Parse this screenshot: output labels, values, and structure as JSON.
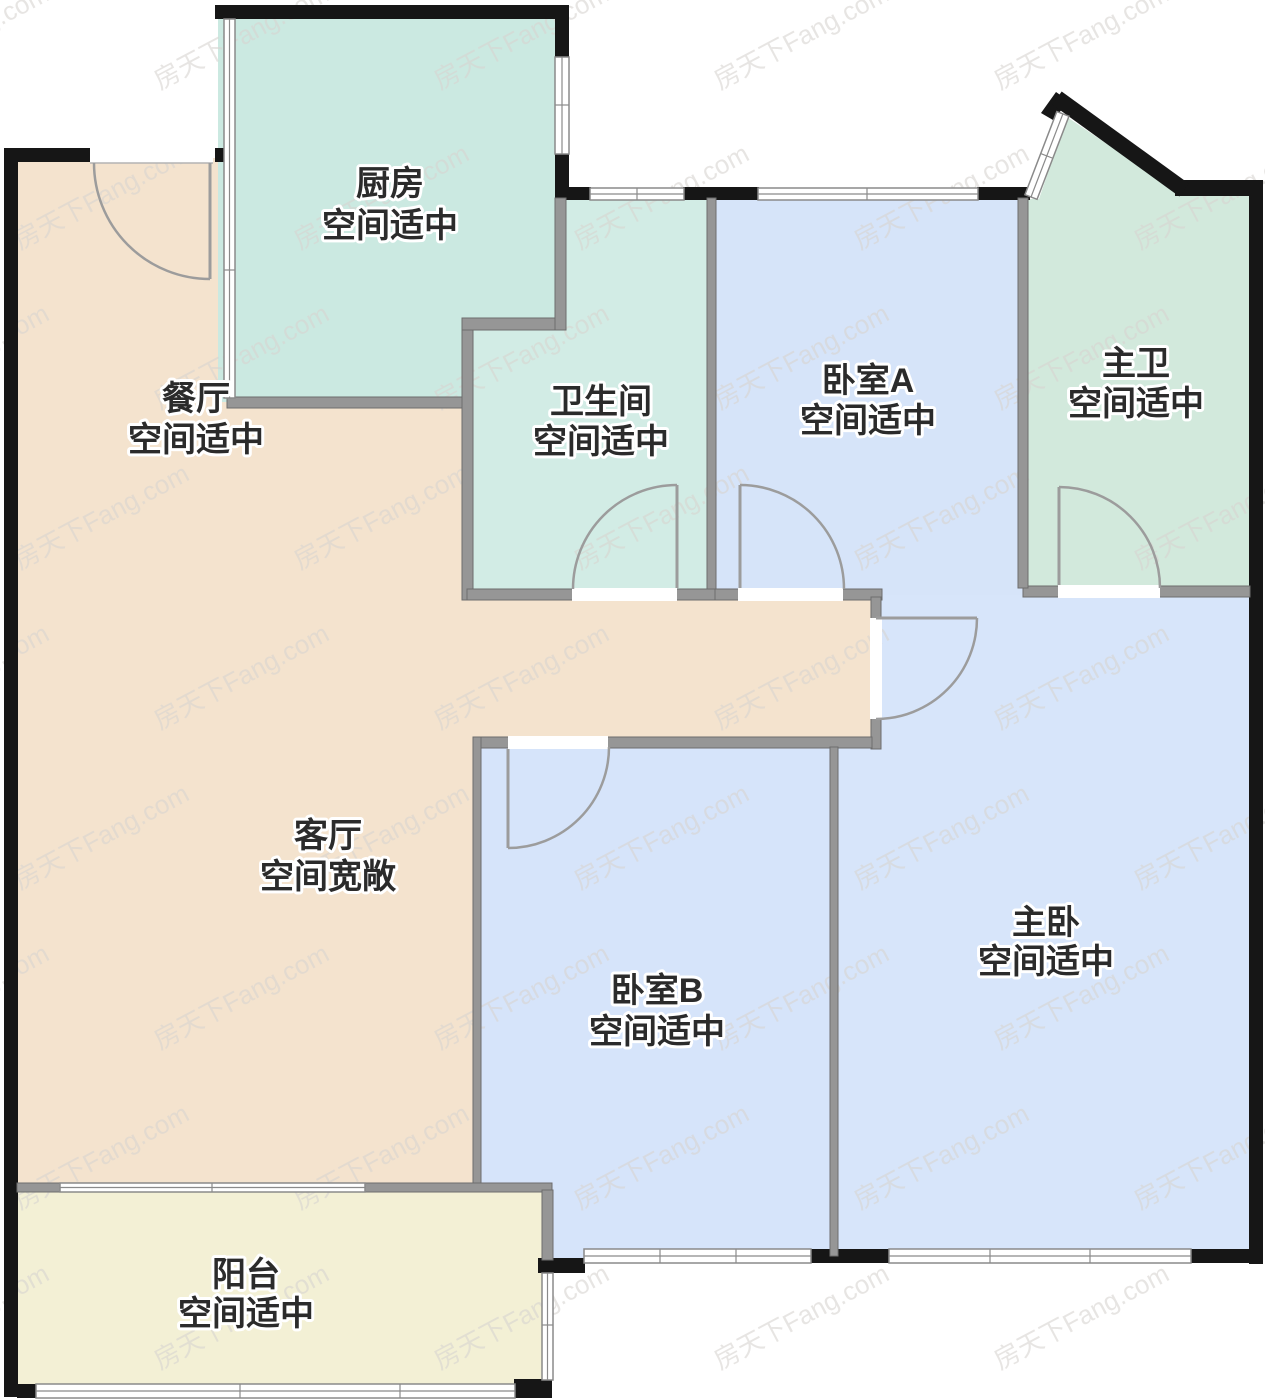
{
  "watermark": {
    "text": "房天下Fang.com"
  },
  "palette": {
    "outer_wall": "#161616",
    "inner_wall": "#969696",
    "window_fill": "#ffffff",
    "window_line": "#8a8a8a",
    "door_arc": "#9c9c9c",
    "label_text": "#2b2b2b",
    "label_halo": "#ffffff",
    "background": "#ffffff",
    "watermark_color": "#d8d5d1"
  },
  "rooms": [
    {
      "id": "kitchen",
      "name": "厨房",
      "desc": "空间适中",
      "color": "#cbe9e1"
    },
    {
      "id": "dining",
      "name": "餐厅",
      "desc": "空间适中",
      "color": "#f4e3ce"
    },
    {
      "id": "bathroom",
      "name": "卫生间",
      "desc": "空间适中",
      "color": "#d2ece5"
    },
    {
      "id": "bedroom-a",
      "name": "卧室A",
      "desc": "空间适中",
      "color": "#d6e4f9"
    },
    {
      "id": "master-bath",
      "name": "主卫",
      "desc": "空间适中",
      "color": "#d2e9dc"
    },
    {
      "id": "living",
      "name": "客厅",
      "desc": "空间宽敞",
      "color": "#f4e3ce"
    },
    {
      "id": "bedroom-b",
      "name": "卧室B",
      "desc": "空间适中",
      "color": "#d6e4fa"
    },
    {
      "id": "master-bedroom",
      "name": "主卧",
      "desc": "空间适中",
      "color": "#d7e5fa"
    },
    {
      "id": "balcony",
      "name": "阳台",
      "desc": "空间适中",
      "color": "#f3f0d5"
    }
  ]
}
